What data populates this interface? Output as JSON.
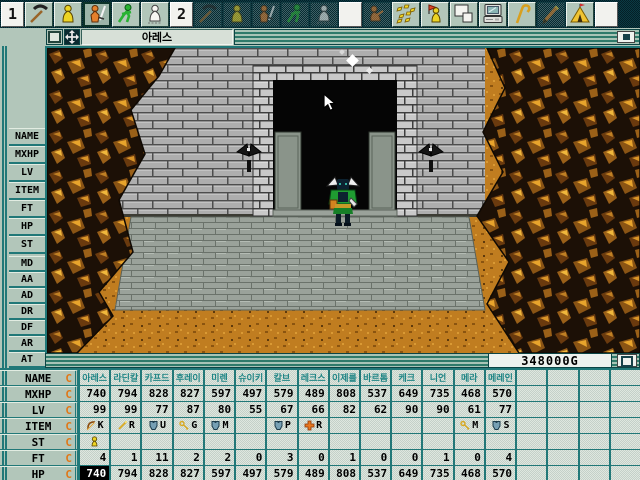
{
  "window": {
    "title": "아레스"
  },
  "toolbar": {
    "items": [
      {
        "label": "1"
      },
      {
        "icon": "pickaxe"
      },
      {
        "icon": "person-standing"
      },
      {
        "icon": "person-sword",
        "state": "selected"
      },
      {
        "icon": "person-running"
      },
      {
        "icon": "person-white"
      },
      {
        "label": "2"
      },
      {
        "icon": "pickaxe",
        "state": "disabled"
      },
      {
        "icon": "person-standing",
        "state": "disabled"
      },
      {
        "icon": "person-sword",
        "state": "disabled"
      },
      {
        "icon": "person-running",
        "state": "disabled"
      },
      {
        "icon": "person-white",
        "state": "disabled"
      },
      {
        "label": ""
      },
      {
        "icon": "person-sitting",
        "state": "disabled"
      },
      {
        "icon": "gems"
      },
      {
        "icon": "person-flag"
      },
      {
        "icon": "windows"
      },
      {
        "icon": "computer"
      },
      {
        "icon": "cane"
      },
      {
        "icon": "pencil",
        "state": "disabled"
      },
      {
        "icon": "tent"
      },
      {
        "label": ""
      }
    ]
  },
  "sidebar": {
    "group1": [
      "NAME",
      "MXHP",
      "LV",
      "ITEM",
      "FT",
      "HP",
      "ST"
    ],
    "group2": [
      "MD",
      "AA",
      "AD",
      "DR",
      "DF",
      "AR",
      "AT"
    ]
  },
  "status": {
    "gold": "348000G"
  },
  "party_table": {
    "rows": [
      {
        "key": "name",
        "label": "NAME",
        "suffix": "C"
      },
      {
        "key": "mxhp",
        "label": "MXHP",
        "suffix": "C"
      },
      {
        "key": "lv",
        "label": "LV",
        "suffix": "C"
      },
      {
        "key": "item",
        "label": "ITEM",
        "suffix": "C"
      },
      {
        "key": "st",
        "label": "ST",
        "suffix": "C"
      },
      {
        "key": "ft",
        "label": "FT",
        "suffix": "C"
      },
      {
        "key": "hp",
        "label": "HP",
        "suffix": "C"
      }
    ],
    "total_columns": 18,
    "members": [
      {
        "name": "아레스",
        "mxhp": "740",
        "lv": "99",
        "item_icon": "bow",
        "item": "K",
        "st_icon": "person",
        "ft": "4",
        "hp": "740",
        "hp_inverted": true
      },
      {
        "name": "라딘칼",
        "mxhp": "794",
        "lv": "99",
        "item_icon": "wand",
        "item": "R",
        "ft": "1",
        "hp": "794"
      },
      {
        "name": "카프드",
        "mxhp": "828",
        "lv": "77",
        "item_icon": "armor",
        "item": "U",
        "ft": "11",
        "hp": "828"
      },
      {
        "name": "후레이",
        "mxhp": "827",
        "lv": "87",
        "item_icon": "key",
        "item": "G",
        "ft": "2",
        "hp": "827"
      },
      {
        "name": "미렌",
        "mxhp": "597",
        "lv": "80",
        "item_icon": "armor",
        "item": "M",
        "ft": "2",
        "hp": "597"
      },
      {
        "name": "슈이키",
        "mxhp": "497",
        "lv": "55",
        "ft": "0",
        "hp": "497"
      },
      {
        "name": "칼브",
        "mxhp": "579",
        "lv": "67",
        "item_icon": "armor",
        "item": "P",
        "ft": "3",
        "hp": "579"
      },
      {
        "name": "레크스",
        "mxhp": "489",
        "lv": "66",
        "item_icon": "cross",
        "item": "R",
        "ft": "0",
        "hp": "489"
      },
      {
        "name": "이제를",
        "mxhp": "808",
        "lv": "82",
        "ft": "1",
        "hp": "808"
      },
      {
        "name": "바르톰",
        "mxhp": "537",
        "lv": "62",
        "ft": "0",
        "hp": "537"
      },
      {
        "name": "케크",
        "mxhp": "649",
        "lv": "90",
        "ft": "0",
        "hp": "649"
      },
      {
        "name": "니언",
        "mxhp": "735",
        "lv": "90",
        "ft": "1",
        "hp": "735"
      },
      {
        "name": "메라",
        "mxhp": "468",
        "lv": "61",
        "item_icon": "key",
        "item": "M",
        "ft": "0",
        "hp": "468"
      },
      {
        "name": "메레인",
        "mxhp": "570",
        "lv": "77",
        "item_icon": "armor",
        "item": "S",
        "ft": "4",
        "hp": "570"
      }
    ]
  },
  "colors": {
    "panel_sage": "#b2c6ba",
    "teal_border": "#217878",
    "toolbar_bg": "#07333c",
    "accent_orange": "#e07818",
    "name_text_teal": "#1f8585",
    "floor_orange": "#c07d20",
    "wall_gray": "#aeaeae"
  }
}
